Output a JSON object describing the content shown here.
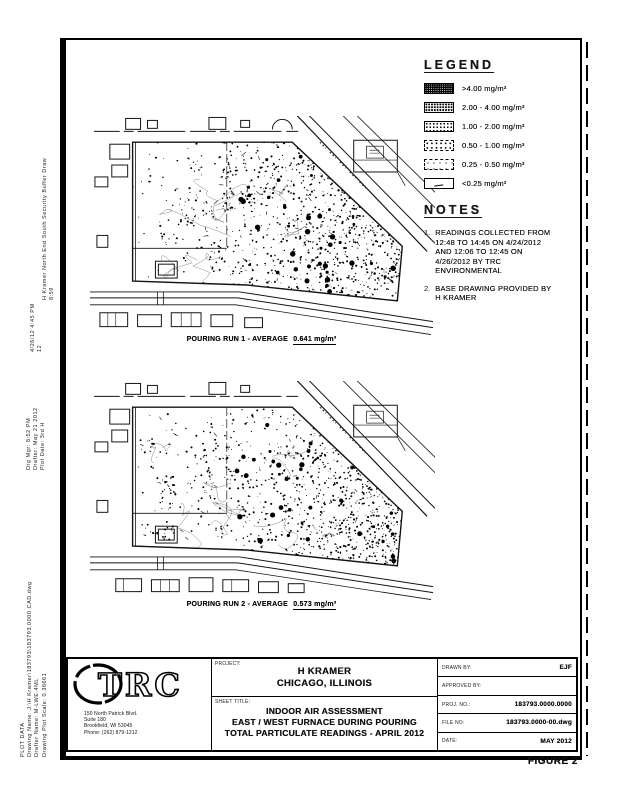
{
  "sheet": {
    "figure_label": "FIGURE 2"
  },
  "legend": {
    "title": "LEGEND",
    "items": [
      {
        "tier": "1",
        "range": ">4.00 mg/m³"
      },
      {
        "tier": "2",
        "range": "2.00 - 4.00 mg/m³"
      },
      {
        "tier": "3",
        "range": "1.00 - 2.00 mg/m³"
      },
      {
        "tier": "4",
        "range": "0.50 - 1.00 mg/m³"
      },
      {
        "tier": "5",
        "range": "0.25 - 0.50 mg/m³"
      },
      {
        "tier": "6",
        "range": "<0.25 mg/m³"
      }
    ]
  },
  "notes": {
    "title": "NOTES",
    "items": [
      {
        "num": "1.",
        "text": "READINGS COLLECTED FROM 12:48 TO 14:45 ON 4/24/2012 AND 12:06 TO 12:45 ON 4/26/2012 BY TRC ENVIRONMENTAL"
      },
      {
        "num": "2.",
        "text": "BASE DRAWING PROVIDED BY H KRAMER"
      }
    ]
  },
  "maps": {
    "run1": {
      "caption_prefix": "POURING RUN 1 - AVERAGE",
      "caption_value": "0.641 mg/m³"
    },
    "run2": {
      "caption_prefix": "POURING RUN 2 - AVERAGE",
      "caption_value": "0.573 mg/m³"
    }
  },
  "title_block": {
    "logo_text": "TRC",
    "address": [
      "150 North Patrick Blvd.",
      "Suite 180",
      "Brookfield, WI 53045",
      "Phone: (262) 879-1212"
    ],
    "project_label": "PROJECT:",
    "project_lines": [
      "H KRAMER",
      "CHICAGO, ILLINOIS"
    ],
    "sheet_title_label": "SHEET TITLE:",
    "sheet_title_lines": [
      "INDOOR AIR ASSESSMENT",
      "EAST / WEST FURNACE DURING POURING",
      "TOTAL PARTICULATE READINGS - APRIL 2012"
    ],
    "fields": [
      {
        "label": "DRAWN BY:",
        "value": "EJF"
      },
      {
        "label": "APPROVED BY:",
        "value": ""
      },
      {
        "label": "PROJ. NO.:",
        "value": "183793.0000.0000"
      },
      {
        "label": "FILE NO:",
        "value": "183793.0000-00.dwg"
      },
      {
        "label": "DATE:",
        "value": "MAY 2012"
      }
    ]
  },
  "stamps": {
    "s1": {
      "lines": [
        "H Kramer North End South Security Buffer Draw",
        "8:59"
      ]
    },
    "s2": {
      "lines": [
        "4/26/12  4:45 PM",
        "12"
      ]
    },
    "s3": {
      "lines": [
        "Drg Mgr:  8:52 PM",
        "Drafter:  May 21 2012",
        "Plot Date:  3rd H"
      ]
    },
    "s4": {
      "lines": [
        "PLOT DATA",
        "Drawing Name:  J:\\H Kramer\\183793\\183793.0000 CAD.dwg",
        "Drafter Name:  M-LWE.4ML",
        "Drawing Plot Scale:  0.36661"
      ]
    }
  }
}
